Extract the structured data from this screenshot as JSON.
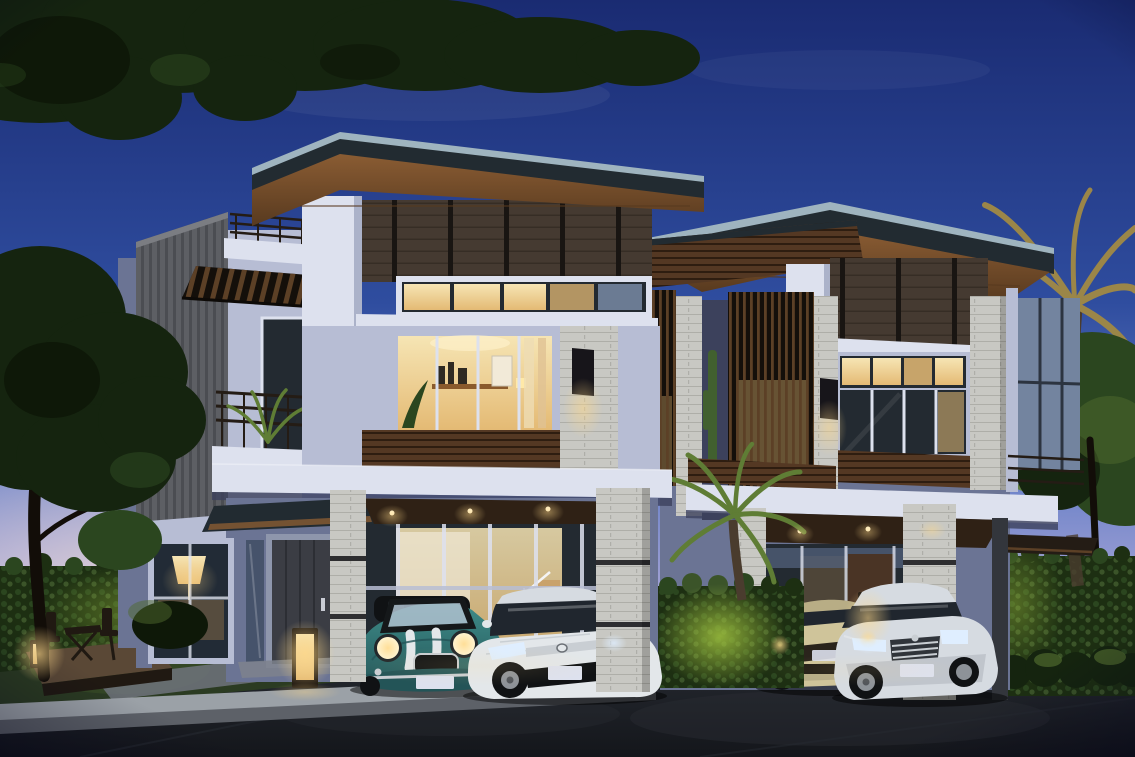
{
  "scene": {
    "type": "architectural-exterior-rendering",
    "time_of_day": "dusk",
    "description": "Dusk architectural rendering of two modern three-storey townhouses with stacked-stone pillars, timber louver screens, warmly lit interiors and carports sheltering four cars, framed by trees, palms and clipped hedges along a quiet street.",
    "objects": [
      "dusk sky",
      "overhanging tree canopy",
      "left garden tree",
      "privacy hedges",
      "uplit hedge",
      "front lawn",
      "timber deck with folding table and chairs",
      "garden lanterns",
      "asphalt street with concrete curb",
      "left townhouse",
      "right townhouse",
      "rooftop terrace railing",
      "timber pergola",
      "stone feature wall",
      "balcony with plants",
      "wood louver screens",
      "stacked-stone pillars",
      "carports",
      "entrance door",
      "glass staircase wall",
      "wall sconces",
      "palm trees"
    ],
    "cars": [
      {
        "label": "teal mini convertible with white bonnet stripes",
        "color": "#3f8d8a"
      },
      {
        "label": "white sedan",
        "color": "#e3e7ea"
      },
      {
        "label": "beige hatchback",
        "color": "#cfc49a"
      },
      {
        "label": "silver luxury sedan",
        "color": "#d6dbe1"
      }
    ]
  },
  "palette": {
    "sky_top": "#1a2b72",
    "sky_mid": "#2f4d9f",
    "sky_low": "#6d83c9",
    "horizon_lavender": "#a9a6d6",
    "horizon_pink": "#dcc2cf",
    "horizon_cream": "#f2ddd8",
    "foliage_dark": "#15240f",
    "foliage_deep": "#0e1808",
    "foliage_mid": "#2b461f",
    "foliage_light": "#4f6a2e",
    "hedge_hi": "#3b5429",
    "hedge_lo": "#1d2f12",
    "hedge_lit": "#9fc23f",
    "grass": "#2b3b22",
    "trunk": "#4a3c2e",
    "trunk_dark": "#120d08",
    "palm_olive": "#9b8648",
    "palm_green": "#5f7d35",
    "wall_light": "#dde1ee",
    "wall_mid": "#b7bdd4",
    "wall_shadow": "#8b92b0",
    "wall_dusk": "#6b7494",
    "wall_navy": "#3c415c",
    "wood_clad": "#453a31",
    "wood_clad_dark": "#191512",
    "wood_clad_line": "#362d25",
    "wood_soffit": "#8a5c33",
    "wood_soffit_deep": "#583a1f",
    "wood_sill": "#543823",
    "wood_sill_dark": "#2e1d10",
    "louver_lit": "#5c4026",
    "louver_back": "#140f0a",
    "stone_light": "#c8c8c3",
    "stone_shade": "#aeaea8",
    "stone_wall": "#5d5f64",
    "stone_stria": "#4b4d52",
    "glass_night": "#232a31",
    "glass_dusk": "#73849f",
    "glass_reflect": "#aebfce",
    "win_warm": "#f6e5b4",
    "win_amber": "#e4ba74",
    "glow_warm": "#ffd98a",
    "interior_wood": "#c9a26b",
    "roof_dark": "#222b31",
    "roof_edge": "#9fb4bf",
    "road_dark": "#14161b",
    "road_light": "#262a31",
    "curb_top": "#9ba1a7",
    "curb_face": "#5d6168",
    "walkway": "#70747c",
    "deck_wood": "#5a4836",
    "furniture_dark": "#201912",
    "door_charcoal": "#3b3d44",
    "door_wood": "#4a3425",
    "mini_teal": "#3f8d8a",
    "mini_teal_dark": "#235457",
    "honda_white": "#e3e7ea",
    "car_beige": "#cfc49a",
    "car_silver": "#d6dbe1",
    "car_glass": "#20262e",
    "wheel_dark": "#101214",
    "rim_gray": "#8d9298",
    "chrome": "#c9ced3",
    "headlight_warm": "#fff3cf",
    "headlight_cool": "#dfeeff",
    "rail_dark": "#241c15",
    "shadow_navy": "#000018"
  }
}
